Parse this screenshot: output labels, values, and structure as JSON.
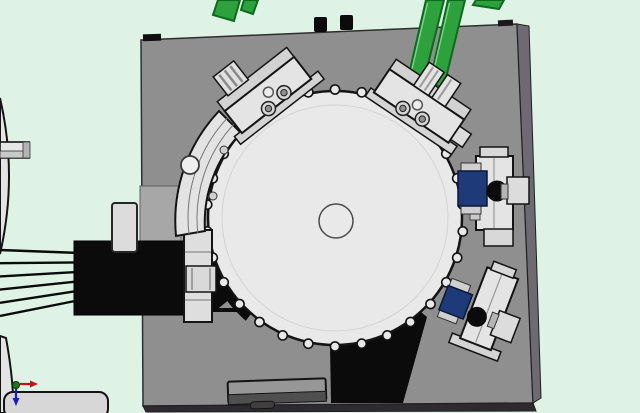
{
  "scene": {
    "type": "cad-top-view",
    "description": "Top view of a rotary indexing table machine assembly on a square base plate",
    "visible_text": []
  },
  "colors": {
    "background": "#def2e6",
    "plate": "#8f8f8f",
    "plate_light": "#a7a7a7",
    "plate_side_right": "#6e6a72",
    "plate_side_bottom": "#2d2b2f",
    "disc_fill": "#e9e9e9",
    "disc_inner_ring": "#d4d4d4",
    "outline": "#141414",
    "station_fill": "#e4e4e4",
    "station_shade": "#d4d4d4",
    "navy_block": "#1e3a78",
    "black_part": "#0b0b0b",
    "belt_green": "#2da23c",
    "belt_green_dark": "#0d6b1d",
    "belt_green_light": "#7fd08a",
    "bar_top": "#979797",
    "bar_bottom": "#4f4f4f",
    "left_part_fill": "#e4e4e4",
    "bracket_fill": "#dedede",
    "triad_origin": "#1b7a1b",
    "triad_x": "#c01414",
    "triad_y": "#1a1ac0"
  },
  "disc": {
    "cx": 335,
    "cy": 218,
    "r": 127,
    "notch_count": 30,
    "notch_orbit": 128.5,
    "notch_radius": 4.6,
    "center_hole_r": 17,
    "inner_ring_r": 113
  },
  "motor_leads": {
    "count": 6,
    "x0": 0,
    "x1": 80,
    "y0_start": 250,
    "y0_step": 13.2,
    "y1_start": 253,
    "y1_step": 9.4
  }
}
